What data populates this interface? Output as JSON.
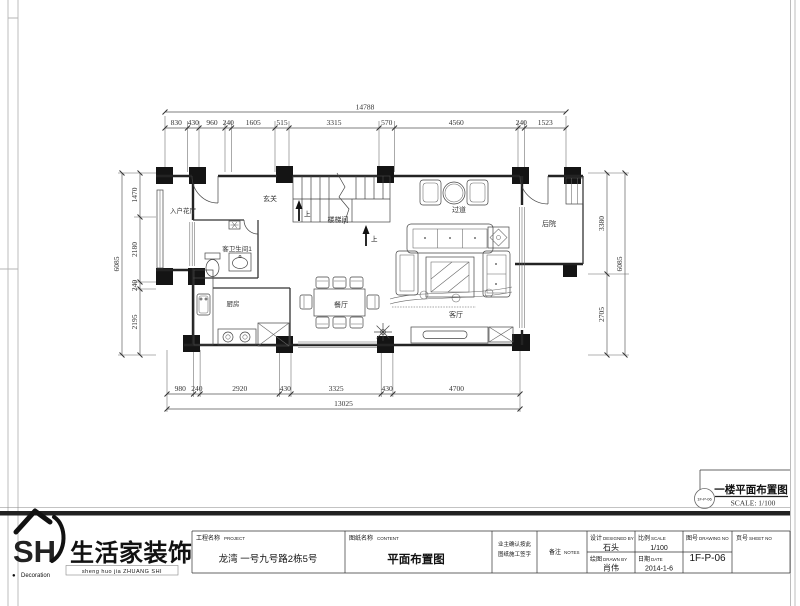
{
  "sheet": {
    "drawing_label": {
      "badge": "1F-P-06",
      "title": "一楼平面布置图",
      "scale": "SCALE:  1/100"
    }
  },
  "plan": {
    "rooms": {
      "entry_garden": "入户花厅",
      "foyer": "玄关",
      "guest_bath": "客卫生间1",
      "stairwell": "楼梯间",
      "hallway": "过道",
      "backyard": "后院",
      "kitchen": "厨房",
      "dining": "餐厅",
      "living": "客厅"
    },
    "stair_up_label": "上"
  },
  "dims": {
    "top_total": "14788",
    "top_segments": [
      "830",
      "430",
      "960",
      "240",
      "1605",
      "515",
      "3315",
      "570",
      "4560",
      "240",
      "1523"
    ],
    "left_total": "6085",
    "left_segments": [
      "1470",
      "2180",
      "240",
      "2195"
    ],
    "right_total": "6085",
    "right_segments": [
      "3380",
      "2705"
    ],
    "bottom_total": "13025",
    "bottom_segments": [
      "980",
      "240",
      "2920",
      "430",
      "3325",
      "430",
      "4700"
    ]
  },
  "title_block": {
    "logo": {
      "mark": "SH",
      "company": "生活家装饰",
      "pinyin": "sheng  huo  jia  ZHUANG SHI",
      "bullet": "●",
      "sub": "Decoration"
    },
    "project": {
      "label": "工程名称",
      "en": "PROJECT",
      "value": "龙湾 一号九号路2栋5号"
    },
    "content": {
      "label": "图纸名称",
      "en": "CONTENT",
      "value": "平面布置图"
    },
    "confirm": {
      "line1": "业主确认按此",
      "line2": "图纸施工签字"
    },
    "notes": {
      "label": "备注",
      "en": "NOTES"
    },
    "design": {
      "label": "设计",
      "en": "DESIGNED BY",
      "value": "石头"
    },
    "scale": {
      "label": "比例",
      "en": "SCALE",
      "value": "1/100"
    },
    "drawn": {
      "label": "绘图",
      "en": "DRAWN BY",
      "value": "肖伟"
    },
    "date": {
      "label": "日期",
      "en": "DATE",
      "value": "2014-1-6"
    },
    "drawing_no": {
      "label": "图号",
      "en": "DRAWING NO",
      "value": "1F-P-06"
    },
    "sheet_no": {
      "label": "页号",
      "en": "SHEET NO",
      "value": ""
    }
  }
}
